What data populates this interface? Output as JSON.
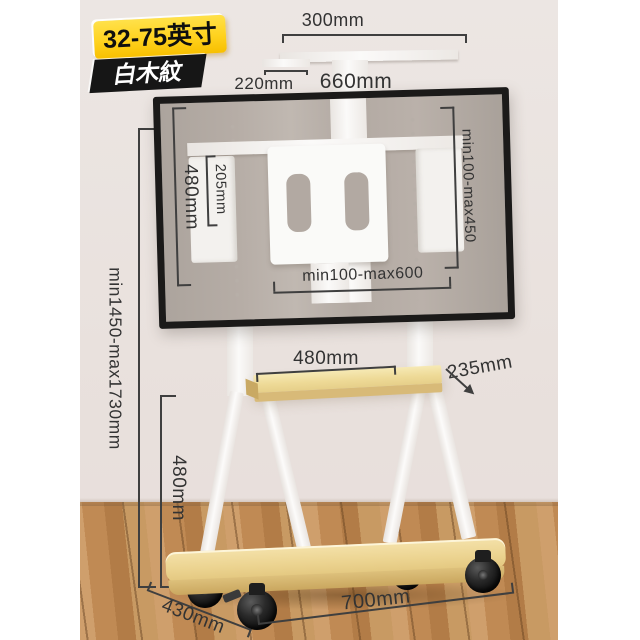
{
  "product_badges": {
    "size_range": "32-75英寸",
    "material": "白木紋"
  },
  "dimensions": {
    "top_bracket_width": "300mm",
    "top_bracket_depth": "220mm",
    "bracket_width": "660mm",
    "bracket_height": "480mm",
    "plate_height": "205mm",
    "vesa_vertical_range": "min100-max450",
    "vesa_horizontal_range": "min100-max600",
    "overall_height_range": "min1450-max1730mm",
    "shelf_width": "480mm",
    "shelf_depth": "235mm",
    "lower_section_height": "480mm",
    "base_depth": "430mm",
    "base_width": "700mm"
  },
  "colors": {
    "badge_yellow": "#ffd21e",
    "badge_black": "#181818",
    "shelf_wood": "#e9d193",
    "floor_wood": "#c2905c",
    "wall": "#eae3e0",
    "frame_white": "#f7f5f2",
    "tv_screen": "#b2a9a2",
    "dim_line": "#3f3f3f"
  }
}
